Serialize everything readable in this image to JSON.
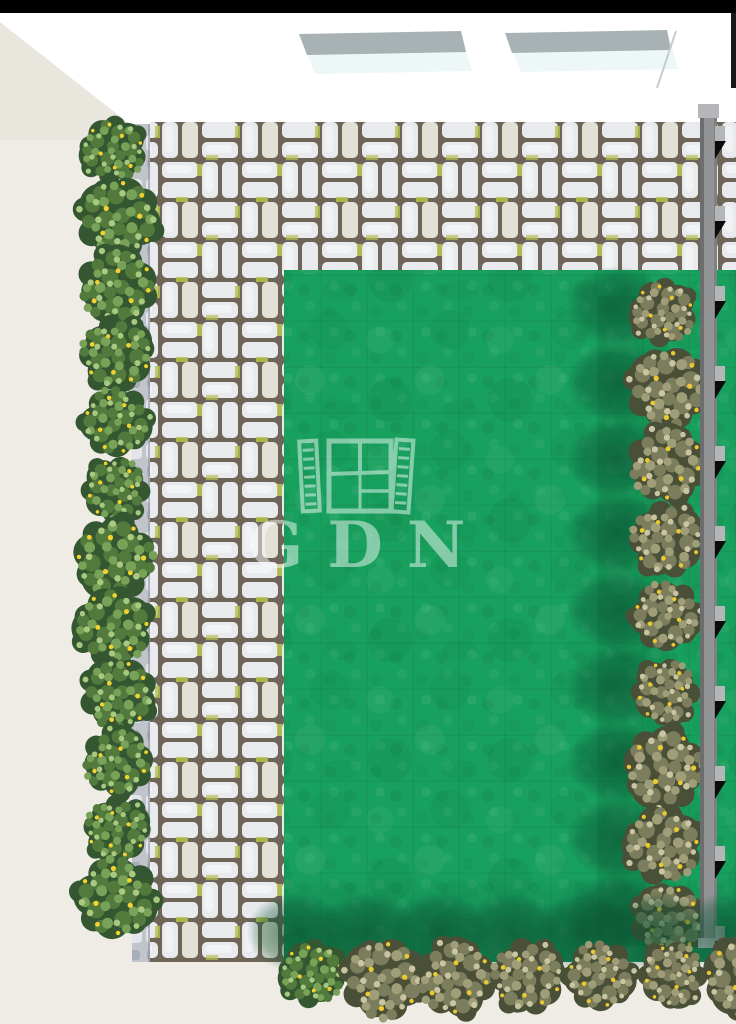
{
  "scene": "garden-plan-top-view-render",
  "watermark": {
    "text": "GDN",
    "icon": "open-window-with-shutters-icon"
  },
  "colors": {
    "top_bar": "#000000",
    "ceiling": "#ffffff",
    "wall": "#e9e6de",
    "floor": "#eeece5",
    "lawn": "#18a05e",
    "paver": "#e9eaed",
    "paver_hi": "#f6f7f9",
    "paver_alt": "#e3e0d6",
    "joint": "#6e6558",
    "moss": "#b5c24f",
    "curb": "#c1c4cb",
    "curb_hi": "#e2e5ea",
    "fence": "#929496",
    "fence_dark": "#6b6d6f",
    "fence_light": "#b4b6b8",
    "fence_notch": "#0c0c0c",
    "skylight_frame": "#a8b2b4",
    "skylight_glass": "#eef7f7",
    "watermark": "#ffffff",
    "bush_green": [
      "#345631",
      "#527a3d",
      "#78a258",
      "#a9c981",
      "#f2d22e"
    ],
    "bush_olive": [
      "#4a4f37",
      "#7b7d5c",
      "#9f9e79",
      "#c9c5a2",
      "#eac931"
    ]
  },
  "fence": {
    "x": 700,
    "width": 17,
    "top": 105,
    "bottom": 948,
    "first_joint": 126,
    "joint_step": 80
  },
  "hedges": [
    {
      "layer": "hedge-left",
      "variant": "green",
      "axis": "y",
      "fixed": 116,
      "from": 150,
      "to": 958,
      "step": 68
    },
    {
      "layer": "hedge-right",
      "variant": "olive",
      "axis": "y",
      "fixed": 666,
      "from": 312,
      "to": 924,
      "step": 76,
      "shadow": {
        "dx": -50,
        "dy": -6
      }
    },
    {
      "layer": "hedge-bottom",
      "variant": "olive",
      "first_variant": "green",
      "axis": "x",
      "fixed": 976,
      "from": 312,
      "to": 744,
      "step": 72,
      "shadow": {
        "dx": -16,
        "dy": -44
      }
    }
  ]
}
